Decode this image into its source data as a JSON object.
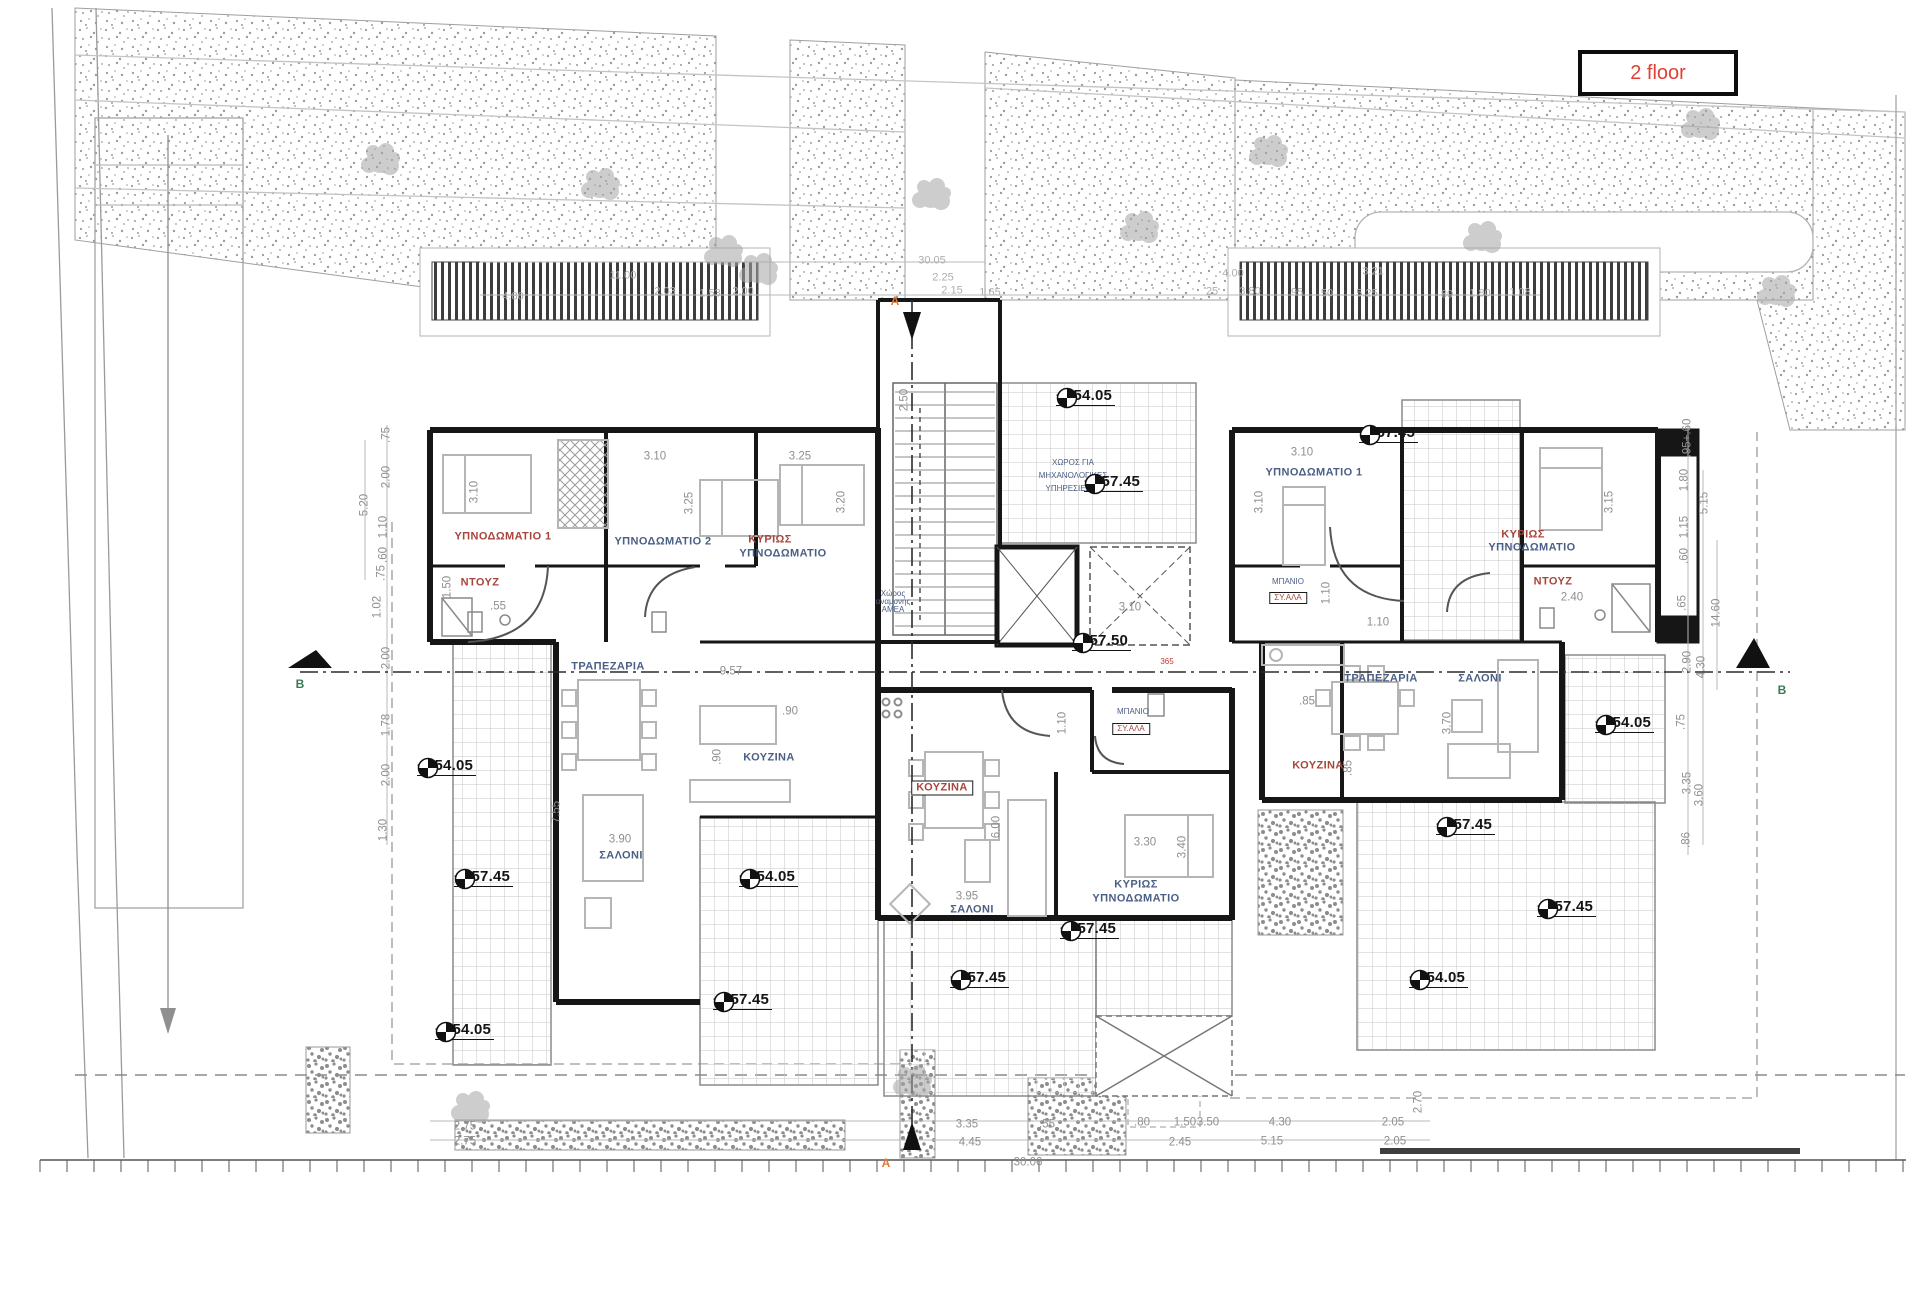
{
  "badge": {
    "text": "2 floor"
  },
  "colors": {
    "accent_red": "#e23f35",
    "room_label_red": "#a8453c",
    "room_label_blue": "#4a5f85",
    "dimension_gray": "#8f8f8f",
    "wall_black": "#161616",
    "section_letter_green": "#3a7a52",
    "section_letter_orange": "#e07b39"
  },
  "plan": {
    "rooms": [
      {
        "t": "ΥΠΝΟΔΩΜΑΤΙΟ 1",
        "x": 503,
        "y": 537,
        "c": "r"
      },
      {
        "t": "ΥΠΝΟΔΩΜΑΤΙΟ 2",
        "x": 663,
        "y": 542,
        "c": "b"
      },
      {
        "t": "ΚΥΡΙΩΣ",
        "x": 770,
        "y": 540,
        "c": "r"
      },
      {
        "t": "ΥΠΝΟΔΩΜΑΤΙΟ",
        "x": 783,
        "y": 554,
        "c": "b"
      },
      {
        "t": "ΝΤΟΥΖ",
        "x": 480,
        "y": 583,
        "c": "r"
      },
      {
        "t": "ΤΡΑΠΕΖΑΡΙΑ",
        "x": 608,
        "y": 667,
        "c": "b"
      },
      {
        "t": "ΚΟΥΖΙΝΑ",
        "x": 769,
        "y": 758,
        "c": "b"
      },
      {
        "t": "ΣΑΛΟΝΙ",
        "x": 621,
        "y": 856,
        "c": "b"
      },
      {
        "t": "ΚΟΥΖΙΝΑ",
        "x": 942,
        "y": 788,
        "c": "r",
        "box": true
      },
      {
        "t": "ΣΑΛΟΝΙ",
        "x": 972,
        "y": 910,
        "c": "b"
      },
      {
        "t": "ΚΥΡΙΩΣ",
        "x": 1136,
        "y": 885,
        "c": "b"
      },
      {
        "t": "ΥΠΝΟΔΩΜΑΤΙΟ",
        "x": 1136,
        "y": 899,
        "c": "b"
      },
      {
        "t": "ΜΠΑΝΙΟ",
        "x": 1133,
        "y": 712,
        "c": "b",
        "tiny": true
      },
      {
        "t": "ΣΥ.ΑΛΑ",
        "x": 1131,
        "y": 729,
        "c": "r",
        "box": true,
        "tiny": true
      },
      {
        "t": "ΥΠΝΟΔΩΜΑΤΙΟ 1",
        "x": 1314,
        "y": 473,
        "c": "b"
      },
      {
        "t": "ΚΥΡΙΩΣ",
        "x": 1523,
        "y": 535,
        "c": "r"
      },
      {
        "t": "ΥΠΝΟΔΩΜΑΤΙΟ",
        "x": 1532,
        "y": 548,
        "c": "b"
      },
      {
        "t": "ΝΤΟΥΖ",
        "x": 1553,
        "y": 582,
        "c": "r"
      },
      {
        "t": "ΜΠΑΝΙΟ",
        "x": 1288,
        "y": 582,
        "c": "b",
        "tiny": true
      },
      {
        "t": "ΣΥ.ΑΛΑ",
        "x": 1288,
        "y": 598,
        "c": "r",
        "box": true,
        "tiny": true
      },
      {
        "t": "ΤΡΑΠΕΖΑΡΙΑ",
        "x": 1381,
        "y": 679,
        "c": "b"
      },
      {
        "t": "ΣΑΛΟΝΙ",
        "x": 1480,
        "y": 679,
        "c": "b"
      },
      {
        "t": "ΚΟΥΖΙΝΑ",
        "x": 1318,
        "y": 766,
        "c": "r"
      },
      {
        "t": "ΧΩΡΟΣ ΓΙΑ",
        "x": 1073,
        "y": 463,
        "c": "b",
        "tiny": true
      },
      {
        "t": "ΜΗΧΑΝΟΛΟΓΙΚΕΣ",
        "x": 1073,
        "y": 476,
        "c": "b",
        "tiny": true
      },
      {
        "t": "ΥΠΗΡΕΣΙΕΣ",
        "x": 1068,
        "y": 489,
        "c": "b",
        "tiny": true
      },
      {
        "t": "Χώρος",
        "x": 893,
        "y": 594,
        "c": "b",
        "tiny": true
      },
      {
        "t": "αναμονής",
        "x": 893,
        "y": 602,
        "c": "b",
        "tiny": true
      },
      {
        "t": "ΑΜΕΑ",
        "x": 893,
        "y": 610,
        "c": "b",
        "tiny": true
      }
    ],
    "elevations": [
      {
        "t": "+154.05",
        "x": 1108,
        "y": 398
      },
      {
        "t": "+157.45",
        "x": 1136,
        "y": 484
      },
      {
        "t": "+157.45",
        "x": 1411,
        "y": 435
      },
      {
        "t": "+157.50",
        "x": 1124,
        "y": 643
      },
      {
        "t": "+154.05",
        "x": 469,
        "y": 768
      },
      {
        "t": "+157.45",
        "x": 506,
        "y": 879
      },
      {
        "t": "+154.05",
        "x": 791,
        "y": 879
      },
      {
        "t": "+157.45",
        "x": 1112,
        "y": 931
      },
      {
        "t": "+157.45",
        "x": 1002,
        "y": 980
      },
      {
        "t": "+157.45",
        "x": 765,
        "y": 1002
      },
      {
        "t": "+154.05",
        "x": 487,
        "y": 1032
      },
      {
        "t": "+154.05",
        "x": 1647,
        "y": 725
      },
      {
        "t": "+157.45",
        "x": 1488,
        "y": 827
      },
      {
        "t": "+157.45",
        "x": 1589,
        "y": 909
      },
      {
        "t": "+154.05",
        "x": 1461,
        "y": 980
      }
    ],
    "section_markers": [
      {
        "t": "B",
        "x": 300,
        "y": 684,
        "c": "#3a7a52"
      },
      {
        "t": "B",
        "x": 1782,
        "y": 690,
        "c": "#3a7a52"
      },
      {
        "t": "A",
        "x": 895,
        "y": 301,
        "c": "#e07b39"
      },
      {
        "t": "A",
        "x": 886,
        "y": 1163,
        "c": "#e07b39"
      }
    ],
    "dims": [
      {
        "t": "4.80",
        "x": 513,
        "y": 297,
        "s": "faint"
      },
      {
        "t": "11.00",
        "x": 623,
        "y": 276,
        "s": "faint"
      },
      {
        "t": "2.03",
        "x": 665,
        "y": 292,
        "s": "faint"
      },
      {
        "t": "1.53",
        "x": 710,
        "y": 294,
        "s": "faint"
      },
      {
        "t": "2.00",
        "x": 743,
        "y": 292,
        "s": "faint"
      },
      {
        "t": "30.05",
        "x": 932,
        "y": 261,
        "s": "faint"
      },
      {
        "t": "2.25",
        "x": 943,
        "y": 278,
        "s": "faint"
      },
      {
        "t": "2.15",
        "x": 952,
        "y": 291,
        "s": "faint"
      },
      {
        "t": "1.65",
        "x": 990,
        "y": 293,
        "s": "faint"
      },
      {
        "t": "4.00",
        "x": 1233,
        "y": 274,
        "s": "faint"
      },
      {
        "t": "3.21",
        "x": 1373,
        "y": 272,
        "s": "faint"
      },
      {
        "t": "25",
        "x": 1212,
        "y": 292,
        "s": "faint"
      },
      {
        "t": "3.80",
        "x": 1250,
        "y": 292,
        "s": "faint"
      },
      {
        "t": "95",
        "x": 1297,
        "y": 293,
        "s": "faint"
      },
      {
        "t": "50",
        "x": 1327,
        "y": 294,
        "s": "faint"
      },
      {
        "t": "5.25",
        "x": 1367,
        "y": 294,
        "s": "faint"
      },
      {
        "t": "80",
        "x": 1447,
        "y": 295,
        "s": "faint"
      },
      {
        "t": "1.80",
        "x": 1480,
        "y": 294,
        "s": "faint"
      },
      {
        "t": "1.08",
        "x": 1520,
        "y": 293,
        "s": "faint"
      },
      {
        "t": ".75",
        "x": 387,
        "y": 435,
        "r": 1
      },
      {
        "t": "2.00",
        "x": 387,
        "y": 477,
        "r": 1
      },
      {
        "t": "1.10",
        "x": 384,
        "y": 527,
        "r": 1
      },
      {
        "t": ".60",
        "x": 384,
        "y": 555,
        "r": 1
      },
      {
        "t": ".75",
        "x": 382,
        "y": 573,
        "r": 1
      },
      {
        "t": "1.02",
        "x": 378,
        "y": 607,
        "r": 1
      },
      {
        "t": "5.20",
        "x": 365,
        "y": 505,
        "r": 1
      },
      {
        "t": "2.00",
        "x": 387,
        "y": 658,
        "r": 1
      },
      {
        "t": "1.78",
        "x": 387,
        "y": 725,
        "r": 1
      },
      {
        "t": "2.00",
        "x": 387,
        "y": 775,
        "r": 1
      },
      {
        "t": "1.30",
        "x": 384,
        "y": 830,
        "r": 1
      },
      {
        "t": ".95+.60",
        "x": 1688,
        "y": 438,
        "r": 1
      },
      {
        "t": "1.80",
        "x": 1685,
        "y": 480,
        "r": 1
      },
      {
        "t": "5.15",
        "x": 1705,
        "y": 503,
        "r": 1
      },
      {
        "t": "1.15",
        "x": 1685,
        "y": 527,
        "r": 1
      },
      {
        "t": ".60",
        "x": 1685,
        "y": 556,
        "r": 1
      },
      {
        "t": ".65",
        "x": 1683,
        "y": 603,
        "r": 1
      },
      {
        "t": "14.60",
        "x": 1717,
        "y": 613,
        "r": 1
      },
      {
        "t": "2.90",
        "x": 1688,
        "y": 662,
        "r": 1
      },
      {
        "t": "4.30",
        "x": 1702,
        "y": 667,
        "r": 1
      },
      {
        "t": ".75",
        "x": 1682,
        "y": 722,
        "r": 1
      },
      {
        "t": "3.35",
        "x": 1688,
        "y": 783,
        "r": 1
      },
      {
        "t": "3.60",
        "x": 1700,
        "y": 795,
        "r": 1
      },
      {
        "t": ".86",
        "x": 1687,
        "y": 840,
        "r": 1
      },
      {
        "t": "3.10",
        "x": 655,
        "y": 457
      },
      {
        "t": "3.25",
        "x": 800,
        "y": 457
      },
      {
        "t": "3.10",
        "x": 475,
        "y": 492,
        "r": 1
      },
      {
        "t": "3.25",
        "x": 690,
        "y": 503,
        "r": 1
      },
      {
        "t": "3.20",
        "x": 842,
        "y": 502,
        "r": 1
      },
      {
        "t": ".55",
        "x": 498,
        "y": 607
      },
      {
        "t": "1.50",
        "x": 448,
        "y": 587,
        "r": 1
      },
      {
        "t": "9.57",
        "x": 731,
        "y": 672
      },
      {
        "t": "7.55",
        "x": 557,
        "y": 812,
        "r": 1
      },
      {
        "t": "3.90",
        "x": 620,
        "y": 840
      },
      {
        "t": ".90",
        "x": 790,
        "y": 712
      },
      {
        "t": ".90",
        "x": 718,
        "y": 757,
        "r": 1
      },
      {
        "t": "2.50",
        "x": 905,
        "y": 400,
        "r": 1
      },
      {
        "t": "3.10",
        "x": 1130,
        "y": 608
      },
      {
        "t": "6.00",
        "x": 997,
        "y": 827,
        "r": 1
      },
      {
        "t": "3.95",
        "x": 967,
        "y": 897
      },
      {
        "t": "3.30",
        "x": 1145,
        "y": 843
      },
      {
        "t": "3.40",
        "x": 1183,
        "y": 847,
        "r": 1
      },
      {
        "t": "1.10",
        "x": 1063,
        "y": 723,
        "r": 1
      },
      {
        "t": "3.10",
        "x": 1302,
        "y": 453
      },
      {
        "t": "3.10",
        "x": 1260,
        "y": 502,
        "r": 1
      },
      {
        "t": "3.15",
        "x": 1610,
        "y": 502,
        "r": 1
      },
      {
        "t": "2.40",
        "x": 1572,
        "y": 598
      },
      {
        "t": "1.10",
        "x": 1378,
        "y": 623
      },
      {
        "t": "1.10",
        "x": 1327,
        "y": 593,
        "r": 1
      },
      {
        "t": ".85",
        "x": 1307,
        "y": 702
      },
      {
        "t": "3.70",
        "x": 1448,
        "y": 723,
        "r": 1
      },
      {
        "t": ".85",
        "x": 1349,
        "y": 768,
        "r": 1
      },
      {
        "t": "365",
        "x": 1167,
        "y": 662,
        "s": "red"
      },
      {
        "t": "2.75",
        "x": 465,
        "y": 1127
      },
      {
        "t": "2.75",
        "x": 465,
        "y": 1142
      },
      {
        "t": "3.35",
        "x": 967,
        "y": 1125
      },
      {
        "t": "4.45",
        "x": 970,
        "y": 1143
      },
      {
        "t": ".55",
        "x": 1047,
        "y": 1125
      },
      {
        "t": "30.06",
        "x": 1028,
        "y": 1163
      },
      {
        "t": ".80",
        "x": 1142,
        "y": 1123
      },
      {
        "t": "1.50",
        "x": 1185,
        "y": 1123
      },
      {
        "t": "3.50",
        "x": 1208,
        "y": 1123
      },
      {
        "t": "4.30",
        "x": 1280,
        "y": 1123
      },
      {
        "t": "2.05",
        "x": 1393,
        "y": 1123
      },
      {
        "t": "2.45",
        "x": 1180,
        "y": 1143
      },
      {
        "t": "5.15",
        "x": 1272,
        "y": 1142
      },
      {
        "t": "2.05",
        "x": 1395,
        "y": 1142
      },
      {
        "t": "2.70",
        "x": 1419,
        "y": 1102,
        "r": 1
      }
    ]
  }
}
